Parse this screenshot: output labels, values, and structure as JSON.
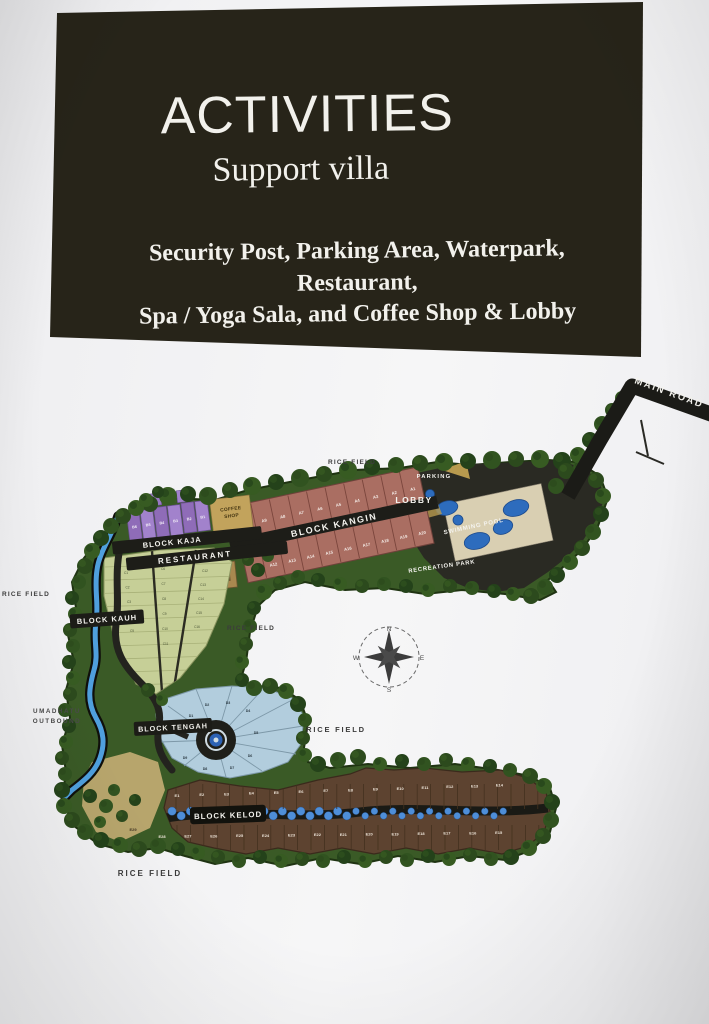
{
  "slide": {
    "title": "ACTIVITIES",
    "subtitle": "Support villa",
    "description": [
      "Security Post, Parking Area, Waterpark, Restaurant,",
      "Spa / Yoga Sala, and Coffee Shop & Lobby"
    ]
  },
  "map": {
    "main_road": "MAIN ROAD",
    "area_labels": {
      "rice_field_top": "RICE FIELD",
      "rice_field_left": "RICE FIELD",
      "rice_field_middle": "RICE FIELD",
      "rice_field_right": "RICE FIELD",
      "rice_field_bottom": "RICE FIELD",
      "parking": "PARKING",
      "lobby": "LOBBY",
      "swimming_pool": "SWIMMING POOL",
      "recreation_park": "RECREATION PARK",
      "coffee_shop": [
        "COFFEE",
        "SHOP"
      ],
      "restaurant": "RESTAURANT",
      "umadhatu_outbound": [
        "UMADHATU",
        "OUTBOUND"
      ]
    },
    "blocks": {
      "kaja": {
        "label": "BLOCK KAJA",
        "plots": [
          "B6",
          "B5",
          "B4",
          "B3",
          "B2",
          "B1"
        ]
      },
      "kangin": {
        "label": "BLOCK KANGIN",
        "plots_top": [
          "A10",
          "A9",
          "A8",
          "A7",
          "A6",
          "A5",
          "A4",
          "A3",
          "A2",
          "A1"
        ],
        "plots_bottom": [
          "A11",
          "A12",
          "A13",
          "A14",
          "A15",
          "A16",
          "A17",
          "A18",
          "A19",
          "A20"
        ]
      },
      "kauh": {
        "label": "BLOCK KAUH",
        "plots_col1": [
          "C1",
          "C2",
          "C3",
          "C4",
          "C5"
        ],
        "plots_col2": [
          "C6",
          "C7",
          "C8",
          "C9",
          "C10",
          "C11"
        ],
        "plots_col3": [
          "C12",
          "C13",
          "C14",
          "C15",
          "C16"
        ]
      },
      "tengah": {
        "label": "BLOCK TENGAH",
        "plots": [
          "D1",
          "D2",
          "D3",
          "D4",
          "D5",
          "D6",
          "D7",
          "D8",
          "D9"
        ]
      },
      "kelod": {
        "label": "BLOCK KELOD",
        "plots_top": [
          "E1",
          "E2",
          "E3",
          "E4",
          "E5",
          "E6",
          "E7",
          "E8",
          "E9",
          "E10",
          "E11",
          "E12",
          "E13",
          "E14"
        ],
        "plots_bottom": [
          "E28",
          "E27",
          "E26",
          "E25",
          "E24",
          "E23",
          "E22",
          "E21",
          "E20",
          "E19",
          "E18",
          "E17",
          "E16",
          "E15"
        ],
        "plot_side": "E29"
      }
    },
    "compass": {
      "north": "N",
      "east": "E",
      "south": "S",
      "west": "W"
    }
  },
  "colors": {
    "card_background": "#272419",
    "card_text": "#f2f1ec",
    "page_background": "#f2f2f4",
    "road": "#1d1d18",
    "river": "#4f9fdd",
    "block_kaja": "#9a79c4",
    "block_kangin": "#aa6e62",
    "block_kauh": "#c6cf97",
    "block_tengah": "#b2cddd",
    "block_kelod": "#5d4330",
    "pool_water": "#2d6cbd",
    "pool_deck": "#d9cfb2",
    "trees": "#2f4f1e"
  }
}
